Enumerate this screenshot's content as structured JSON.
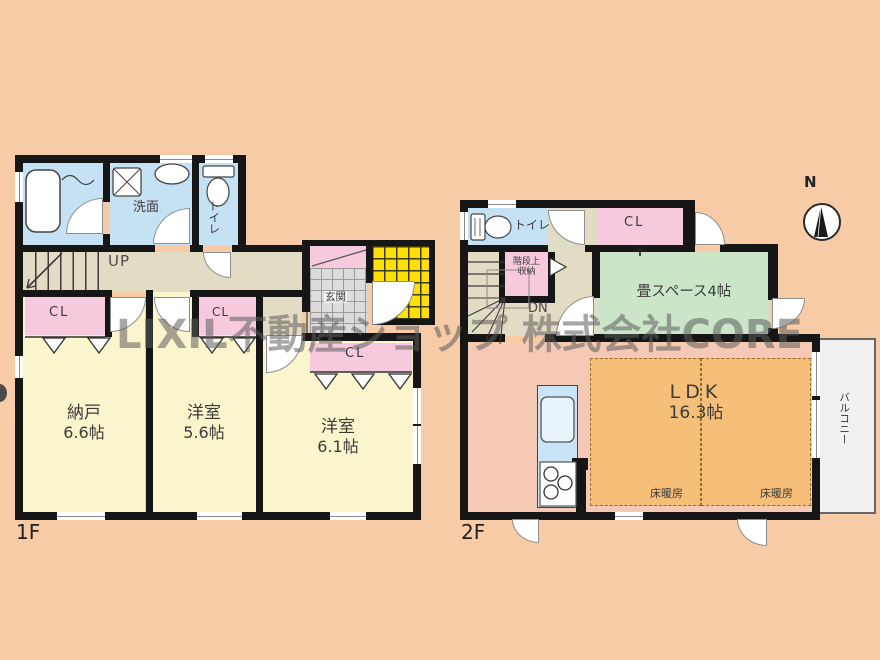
{
  "watermark": {
    "text": "LIXIL不動産ショップ 株式会社CORE"
  },
  "compass": {
    "north": "N"
  },
  "floor1": {
    "floor_label": "1F",
    "washroom": "洗面",
    "toilet": "トイレ",
    "stairs_up": "UP",
    "closet_nando": "CL",
    "closet_west56": "CL",
    "closet_west61": "CL",
    "entrance": "玄関",
    "nando_name": "納戸",
    "nando_size": "6.6帖",
    "west56_name": "洋室",
    "west56_size": "5.6帖",
    "west61_name": "洋室",
    "west61_size": "6.1帖"
  },
  "floor2": {
    "floor_label": "2F",
    "toilet": "トイレ",
    "stair_storage_line1": "階段上",
    "stair_storage_line2": "収納",
    "stairs_down": "DN",
    "closet": "CL",
    "tatami": "畳スペース4帖",
    "ldk_name": "LDK",
    "ldk_size": "16.3帖",
    "floor_heating_left": "床暖房",
    "floor_heating_right": "床暖房",
    "balcony": "バルコニー"
  }
}
